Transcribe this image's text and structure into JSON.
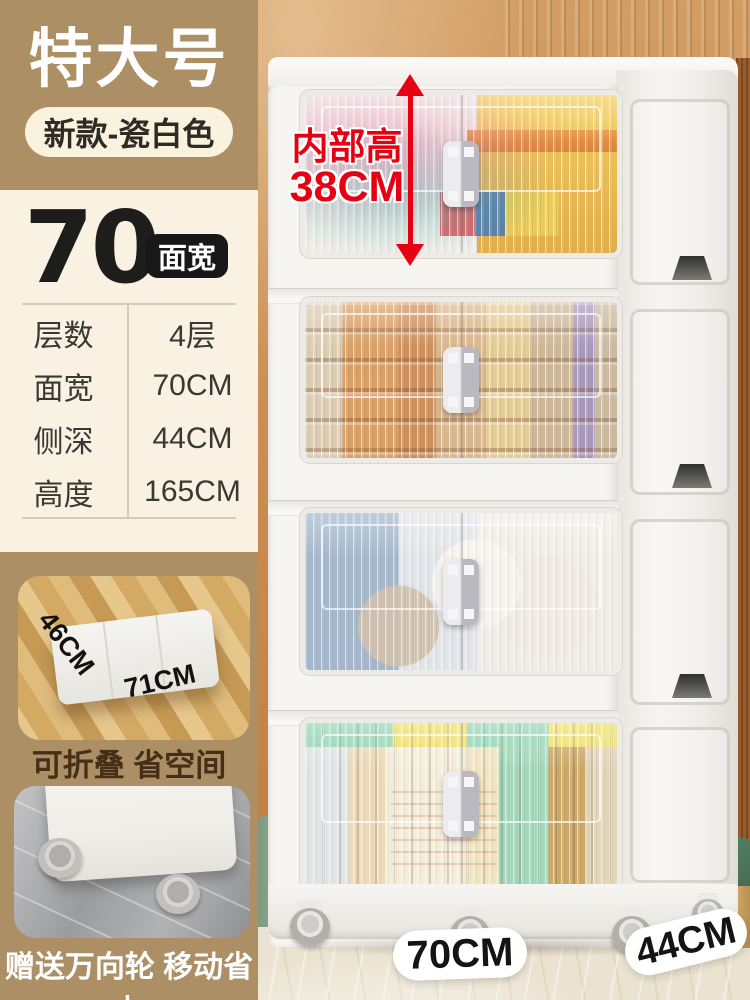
{
  "left_panel": {
    "size_title": "特大号",
    "variant_pill": "新款-瓷白色",
    "width_big_number": "70",
    "width_badge": "面宽",
    "specs": [
      {
        "label": "层数",
        "value": "4层"
      },
      {
        "label": "面宽",
        "value": "70CM"
      },
      {
        "label": "侧深",
        "value": "44CM"
      },
      {
        "label": "高度",
        "value": "165CM"
      }
    ],
    "fold_section": {
      "depth_label": "46CM",
      "width_label": "71CM",
      "caption": "可折叠 省空间"
    },
    "wheels_section": {
      "caption": "赠送万向轮 移动省力"
    }
  },
  "product_annotations": {
    "inner_height_label": "内部高",
    "inner_height_value": "38CM",
    "front_width_tag": "70CM",
    "side_depth_tag": "44CM"
  },
  "colors": {
    "accent_red": "#e60012",
    "tan_block": "#ad8f65",
    "cream_panel": "#f9f1e2",
    "badge_black": "#181818",
    "wall_orange": "#c98c50",
    "cabinet_white": "#f6f5f2"
  }
}
